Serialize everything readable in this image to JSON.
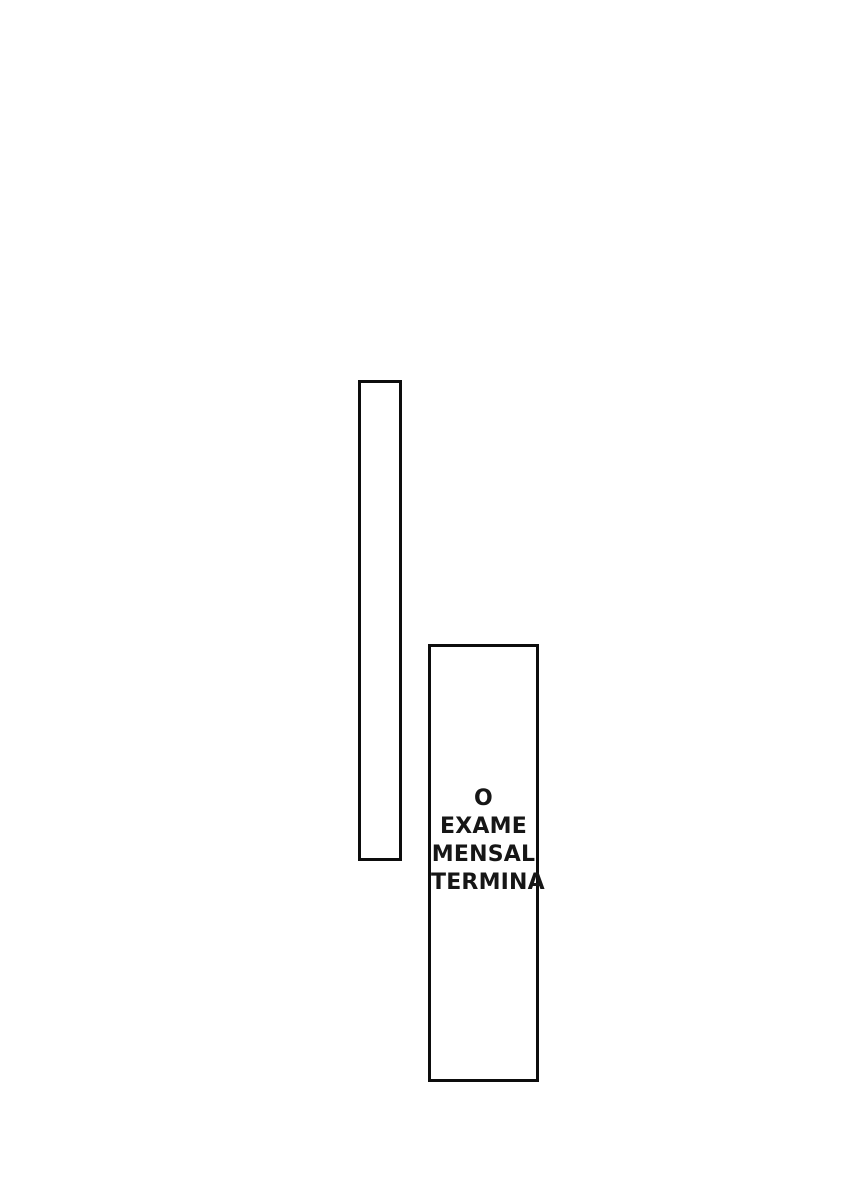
{
  "page": {
    "background_color": "#ffffff",
    "panel_border_color": "#0d0d0d",
    "text_color": "#161616"
  },
  "panels": [
    {
      "name": "empty-vertical-panel",
      "caption": null
    },
    {
      "name": "caption-panel",
      "caption": {
        "text": "O EXAME MENSAL TERMINA",
        "lines": [
          "O",
          "EXAME",
          "MENSAL",
          "TERMINA"
        ]
      }
    }
  ]
}
